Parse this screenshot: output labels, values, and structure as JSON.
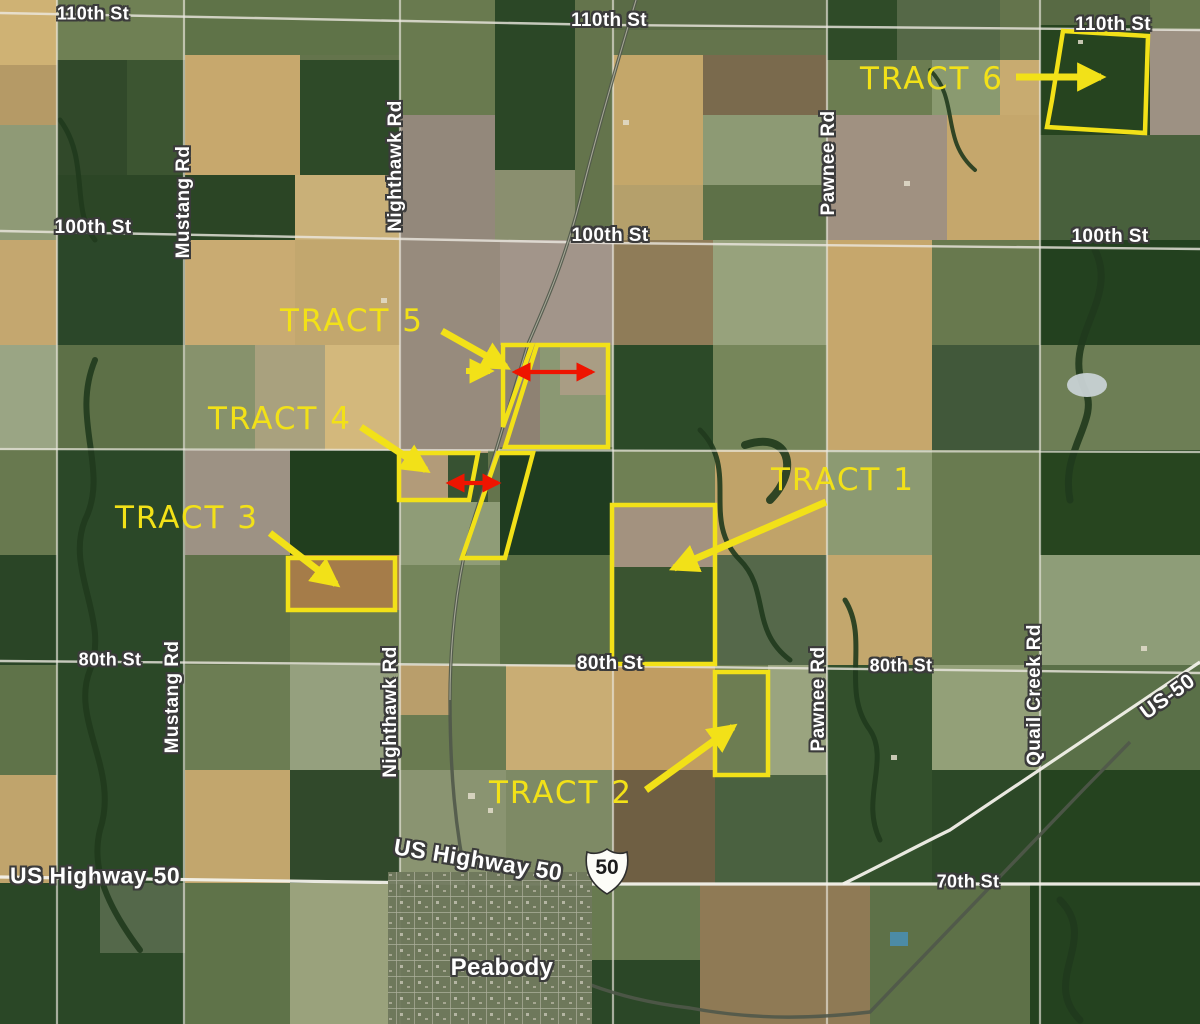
{
  "map": {
    "colors": {
      "tract_yellow": "#f2e118",
      "arrow_red": "#ee1400",
      "road_label_fill": "#ffffff",
      "road_label_outline": "#3b3b3b"
    },
    "shield": {
      "label": "50"
    },
    "road_labels": [
      {
        "name": "110th-st-west",
        "text": "110th St",
        "x": 93,
        "y": 14,
        "rotate": 0,
        "size": 18
      },
      {
        "name": "110th-st-center",
        "text": "110th St",
        "x": 609,
        "y": 21,
        "rotate": 0,
        "size": 19
      },
      {
        "name": "110th-st-east",
        "text": "110th St",
        "x": 1113,
        "y": 25,
        "rotate": 0,
        "size": 19
      },
      {
        "name": "100th-st-west",
        "text": "100th St",
        "x": 93,
        "y": 228,
        "rotate": 0,
        "size": 19
      },
      {
        "name": "100th-st-center",
        "text": "100th St",
        "x": 610,
        "y": 236,
        "rotate": 0,
        "size": 19
      },
      {
        "name": "100th-st-east",
        "text": "100th St",
        "x": 1110,
        "y": 237,
        "rotate": 0,
        "size": 19
      },
      {
        "name": "80th-st-west",
        "text": "80th St",
        "x": 110,
        "y": 660,
        "rotate": 0,
        "size": 18
      },
      {
        "name": "80th-st-center",
        "text": "80th St",
        "x": 610,
        "y": 664,
        "rotate": 0,
        "size": 19
      },
      {
        "name": "80th-st-east",
        "text": "80th St",
        "x": 901,
        "y": 666,
        "rotate": 0,
        "size": 18
      },
      {
        "name": "70th-st",
        "text": "70th St",
        "x": 968,
        "y": 882,
        "rotate": 0,
        "size": 18
      },
      {
        "name": "mustang-rd-north",
        "text": "Mustang Rd",
        "x": 184,
        "y": 202,
        "rotate": -90,
        "size": 19
      },
      {
        "name": "mustang-rd-south",
        "text": "Mustang Rd",
        "x": 173,
        "y": 697,
        "rotate": -90,
        "size": 19
      },
      {
        "name": "nighthawk-rd-north",
        "text": "Nighthawk Rd",
        "x": 396,
        "y": 166,
        "rotate": -90,
        "size": 19
      },
      {
        "name": "nighthawk-rd-south",
        "text": "Nighthawk Rd",
        "x": 391,
        "y": 712,
        "rotate": -90,
        "size": 19
      },
      {
        "name": "pawnee-rd-north",
        "text": "Pawnee Rd",
        "x": 829,
        "y": 163,
        "rotate": -90,
        "size": 19
      },
      {
        "name": "pawnee-rd-south",
        "text": "Pawnee Rd",
        "x": 819,
        "y": 699,
        "rotate": -90,
        "size": 19
      },
      {
        "name": "quail-creek-rd",
        "text": "Quail Creek Rd",
        "x": 1035,
        "y": 695,
        "rotate": -90,
        "size": 19
      },
      {
        "name": "us-highway-50-west",
        "text": "US Highway 50",
        "x": 95,
        "y": 876,
        "rotate": 0,
        "size": 23
      },
      {
        "name": "us-highway-50-peabody",
        "text": "US Highway 50",
        "x": 478,
        "y": 860,
        "rotate": 9,
        "size": 23
      },
      {
        "name": "us-50-east",
        "text": "US-50",
        "x": 1168,
        "y": 697,
        "rotate": -36,
        "size": 21
      }
    ],
    "place_labels": [
      {
        "name": "peabody-town-label",
        "text": "Peabody",
        "x": 502,
        "y": 968,
        "rotate": 0,
        "size": 24
      }
    ],
    "tracts": [
      {
        "id": "tract-1",
        "label": "TRACT 1",
        "label_x": 843,
        "label_y": 480,
        "outline": [
          [
            612,
            505
          ],
          [
            715,
            505
          ],
          [
            715,
            664
          ],
          [
            612,
            664
          ]
        ],
        "arrow": {
          "x1": 826,
          "y1": 502,
          "x2": 674,
          "y2": 568
        }
      },
      {
        "id": "tract-2",
        "label": "TRACT 2",
        "label_x": 561,
        "label_y": 793,
        "outline": [
          [
            715,
            672
          ],
          [
            768,
            672
          ],
          [
            768,
            775
          ],
          [
            715,
            775
          ]
        ],
        "arrow": {
          "x1": 646,
          "y1": 790,
          "x2": 733,
          "y2": 727
        }
      },
      {
        "id": "tract-3",
        "label": "TRACT 3",
        "label_x": 187,
        "label_y": 518,
        "outline": [
          [
            288,
            558
          ],
          [
            395,
            558
          ],
          [
            395,
            610
          ],
          [
            288,
            610
          ]
        ],
        "arrow": {
          "x1": 270,
          "y1": 533,
          "x2": 336,
          "y2": 584
        }
      },
      {
        "id": "tract-4",
        "label": "TRACT 4",
        "label_x": 280,
        "label_y": 419,
        "outline": [
          [
            399,
            453
          ],
          [
            478,
            453
          ],
          [
            469,
            500
          ],
          [
            399,
            500
          ]
        ],
        "extra_outline": [
          [
            498,
            453
          ],
          [
            533,
            453
          ],
          [
            505,
            558
          ],
          [
            462,
            558
          ]
        ],
        "arrow": {
          "x1": 361,
          "y1": 427,
          "x2": 426,
          "y2": 470
        },
        "red_arrow": {
          "x1": 449,
          "y1": 483,
          "x2": 498,
          "y2": 483
        }
      },
      {
        "id": "tract-5",
        "label": "TRACT 5",
        "label_x": 352,
        "label_y": 321,
        "outline": [
          [
            537,
            345
          ],
          [
            608,
            345
          ],
          [
            608,
            447
          ],
          [
            505,
            447
          ]
        ],
        "extra_outline": [
          [
            503,
            345
          ],
          [
            532,
            345
          ],
          [
            503,
            427
          ]
        ],
        "arrow": {
          "x1": 442,
          "y1": 331,
          "x2": 506,
          "y2": 367
        },
        "arrow2": {
          "x1": 466,
          "y1": 371,
          "x2": 490,
          "y2": 371
        },
        "red_arrow": {
          "x1": 515,
          "y1": 372,
          "x2": 592,
          "y2": 372
        }
      },
      {
        "id": "tract-6",
        "label": "TRACT 6",
        "label_x": 932,
        "label_y": 79,
        "outline": [
          [
            1063,
            31
          ],
          [
            1148,
            36
          ],
          [
            1145,
            133
          ],
          [
            1047,
            127
          ],
          [
            1052,
            100
          ]
        ],
        "arrow": {
          "x1": 1016,
          "y1": 77,
          "x2": 1101,
          "y2": 77
        }
      }
    ]
  }
}
